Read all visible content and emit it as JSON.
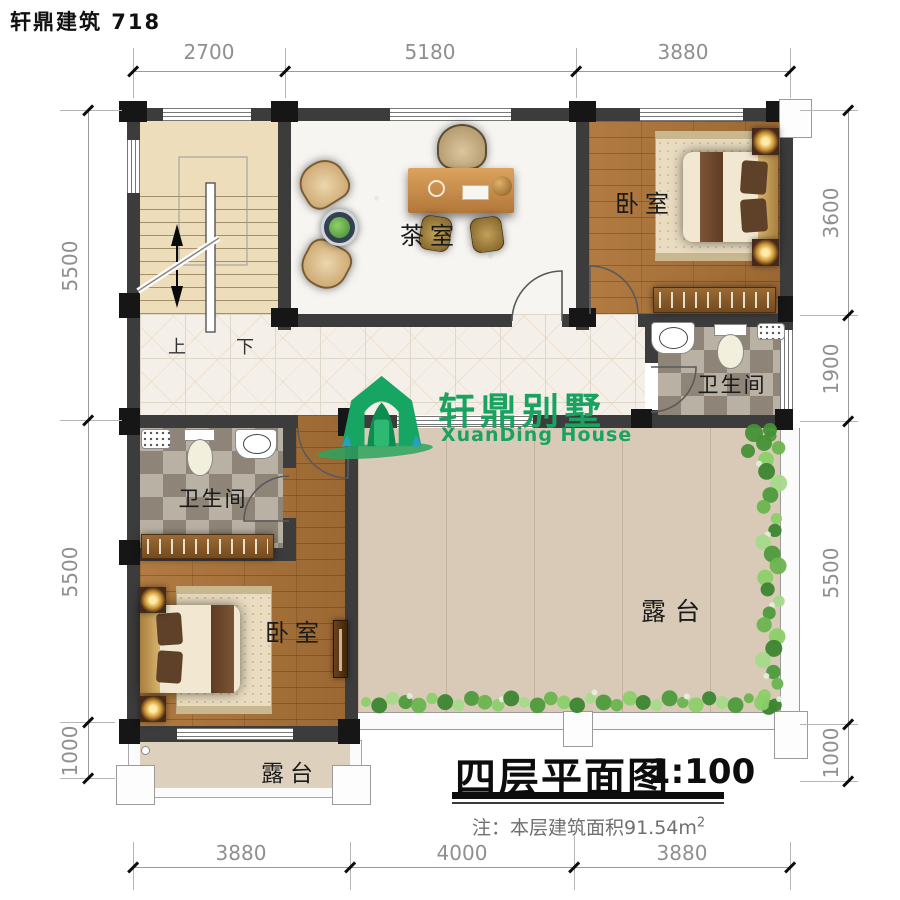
{
  "header": {
    "brand": "轩鼎建筑  718"
  },
  "logo": {
    "name_cn": "轩鼎别墅",
    "name_en": "XuanDing House"
  },
  "titleblock": {
    "title": "四层平面图",
    "scale": "1:100",
    "note": "注：本层建筑面积91.54m",
    "note_sup": "2"
  },
  "rooms": {
    "tea_room": "茶室",
    "bedroom_right": "卧室",
    "bedroom_left": "卧室",
    "bathroom_right": "卫生间",
    "bathroom_left": "卫生间",
    "terrace": "露台",
    "balcony": "露台"
  },
  "stairs": {
    "up": "上",
    "down": "下"
  },
  "dimensions": {
    "top": [
      "2700",
      "5180",
      "3880"
    ],
    "bottom": [
      "3880",
      "4000",
      "3880"
    ],
    "left": [
      "5500",
      "5500",
      "1000"
    ],
    "right": [
      "3600",
      "1900",
      "5500",
      "1000"
    ]
  },
  "colors": {
    "logo_green": "#19a260",
    "wall": "#3c3c3c",
    "wood": "#a9743c",
    "terrace": "#d9cab7",
    "dim_text": "#8f8f8f"
  }
}
